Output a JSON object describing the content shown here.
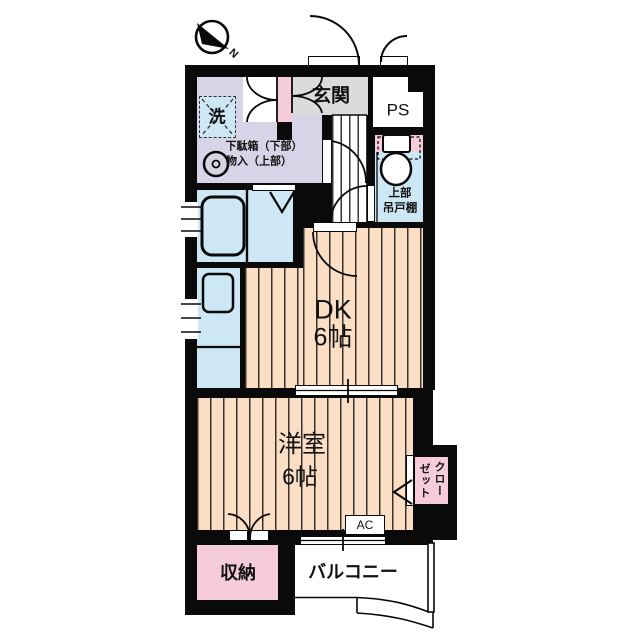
{
  "title": "apartment-floor-plan",
  "compass": {
    "north_label": "N"
  },
  "rooms": {
    "entrance": {
      "label": "玄関"
    },
    "pipe_space": {
      "label": "PS"
    },
    "laundry": {
      "label": "洗"
    },
    "shoe_cabinet": {
      "line1": "下駄箱（下部）",
      "line2": "物入（上部）"
    },
    "toilet_upper_cabinet": {
      "line1": "上部",
      "line2": "吊戸棚"
    },
    "dining_kitchen": {
      "name": "DK",
      "size": "6帖"
    },
    "western_room": {
      "name": "洋室",
      "size": "6帖"
    },
    "closet": {
      "col1": "クロー",
      "col2": "ゼット"
    },
    "air_conditioner": {
      "label": "AC"
    },
    "storage": {
      "label": "収納"
    },
    "balcony": {
      "label": "バルコニー"
    }
  },
  "colors": {
    "wall": "#0a0a0a",
    "wood_floor": "#FBDEC3",
    "washroom": "#D8D4E7",
    "wet_area_blue": "#CDE7F5",
    "accent_pink": "#F6CBDA",
    "entrance_gray": "#DBDBDB",
    "background": "#ffffff"
  }
}
